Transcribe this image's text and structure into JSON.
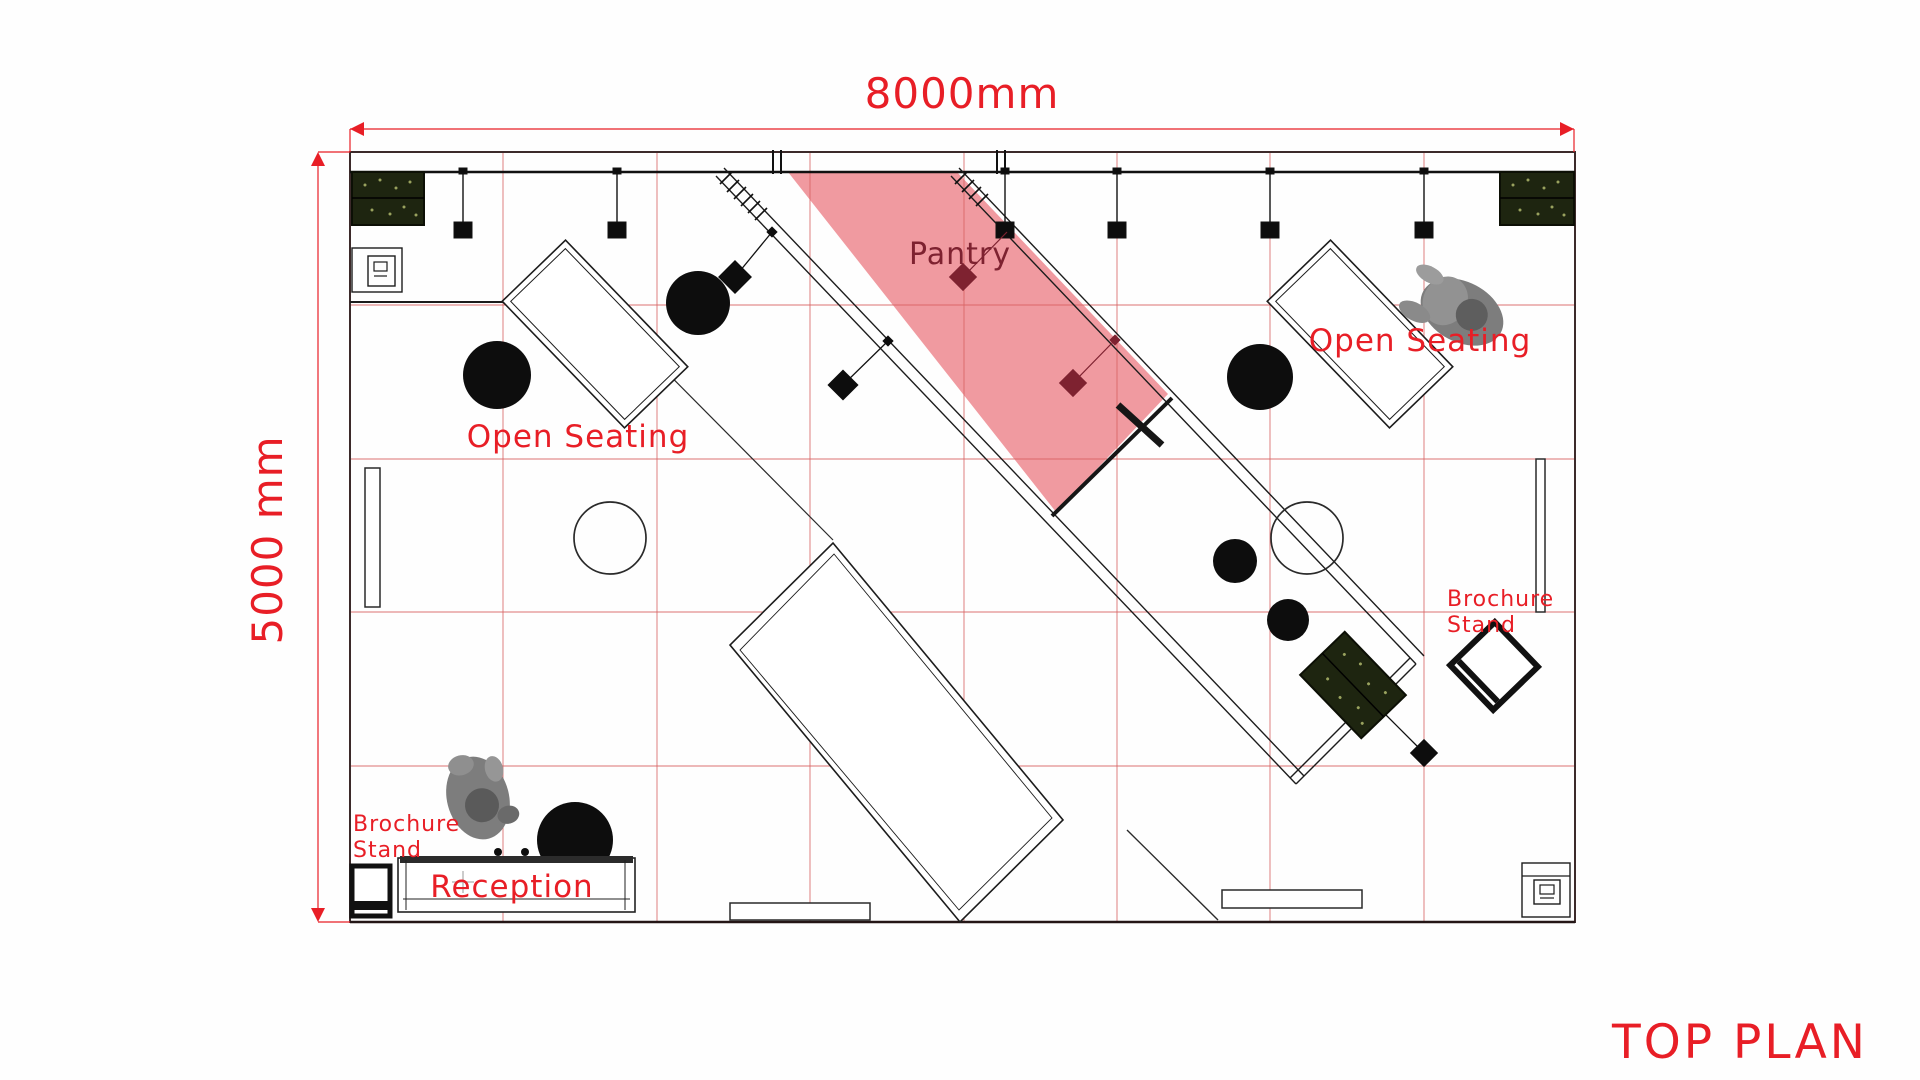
{
  "dimensions": {
    "width_label": "8000mm",
    "height_label": "5000 mm"
  },
  "labels": {
    "pantry": "Pantry",
    "open_seating_left": "Open Seating",
    "open_seating_right": "Open Seating",
    "reception": "Reception",
    "brochure_left_line1": "Brochure",
    "brochure_left_line2": "Stand",
    "brochure_right_line1": "Brochure",
    "brochure_right_line2": "Stand",
    "plan_title": "TOP PLAN"
  },
  "colors": {
    "accent_red": "#e81e26",
    "pantry_maroon": "#7e2230",
    "pantry_fill": "#f09aa0",
    "grid_red": "#d96262",
    "wall_black": "#1c1c1c",
    "planter_green": "#1e2510",
    "person_gray": "#8a8a8a"
  }
}
